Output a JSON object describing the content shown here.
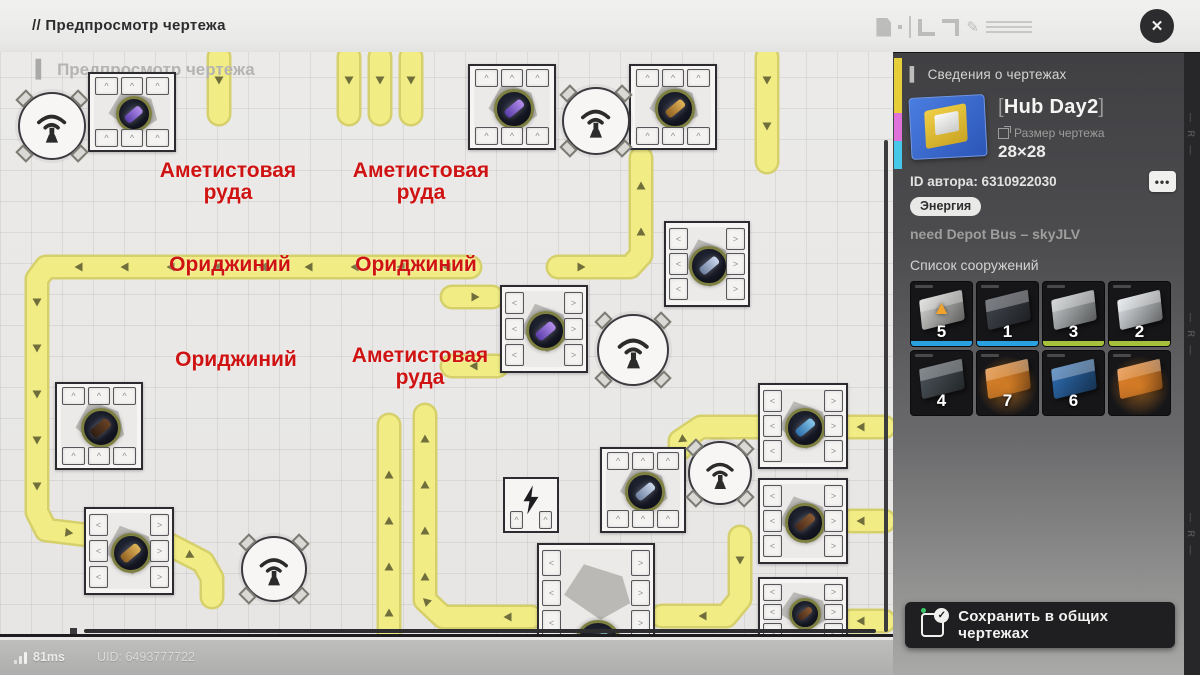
{
  "colors": {
    "belt": "#f1ec84",
    "belt_edge": "#d6d06c",
    "arrow": "#50502b",
    "label_red": "#cf1313",
    "accent_blue": "#2aa1e0",
    "accent_green": "#a6c23c",
    "save_dot_green": "#39c96a"
  },
  "top_bar": {
    "title": "// Предпросмотр чертежа",
    "close_glyph": "✕"
  },
  "map": {
    "watermark_bar": "▍",
    "watermark": "Предпросмотр чертежа",
    "labels": [
      {
        "lines": [
          "Аметистовая",
          "руда"
        ],
        "x": 228,
        "y": 160
      },
      {
        "lines": [
          "Аметистовая",
          "руда"
        ],
        "x": 421,
        "y": 160
      },
      {
        "lines": [
          "Ориджиний"
        ],
        "x": 230,
        "y": 254
      },
      {
        "lines": [
          "Ориджиний"
        ],
        "x": 416,
        "y": 254
      },
      {
        "lines": [
          "Ориджиний"
        ],
        "x": 236,
        "y": 349
      },
      {
        "lines": [
          "Аметистовая",
          "руда"
        ],
        "x": 420,
        "y": 345
      }
    ],
    "ore_colors": {
      "amethyst": [
        "#5a3daa",
        "#b48fec"
      ],
      "gold": [
        "#8f5f22",
        "#e3b559"
      ],
      "slate": [
        "#6c7f9e",
        "#cdd9ee"
      ],
      "blue": [
        "#2d6ea9",
        "#86c6ec"
      ],
      "brown": [
        "#45291a",
        "#8a5a32"
      ],
      "darkbrown": [
        "#2e1d12",
        "#6b4426"
      ],
      "teal": [
        "#2c545e",
        "#79a7b0"
      ]
    },
    "machines": [
      {
        "x": 88,
        "y": 72,
        "w": 88,
        "h": 80,
        "ore": "amethyst",
        "ports": [
          "top",
          "bottom"
        ]
      },
      {
        "x": 468,
        "y": 64,
        "w": 88,
        "h": 86,
        "ore": "amethyst",
        "ports": [
          "top",
          "bottom"
        ]
      },
      {
        "x": 629,
        "y": 64,
        "w": 88,
        "h": 86,
        "ore": "gold",
        "ports": [
          "top",
          "bottom"
        ]
      },
      {
        "x": 664,
        "y": 221,
        "w": 86,
        "h": 86,
        "ore": "slate",
        "ports": [
          "left",
          "right"
        ]
      },
      {
        "x": 500,
        "y": 285,
        "w": 88,
        "h": 88,
        "ore": "amethyst",
        "ports": [
          "left",
          "right"
        ]
      },
      {
        "x": 55,
        "y": 382,
        "w": 88,
        "h": 88,
        "ore": "darkbrown",
        "ports": [
          "top",
          "bottom"
        ]
      },
      {
        "x": 600,
        "y": 447,
        "w": 86,
        "h": 86,
        "ore": "slate",
        "ports": [
          "top",
          "bottom"
        ]
      },
      {
        "x": 758,
        "y": 383,
        "w": 90,
        "h": 86,
        "ore": "blue",
        "ports": [
          "left",
          "right"
        ]
      },
      {
        "x": 758,
        "y": 478,
        "w": 90,
        "h": 86,
        "ore": "brown",
        "ports": [
          "left",
          "right"
        ]
      },
      {
        "x": 758,
        "y": 577,
        "w": 90,
        "h": 70,
        "ore": "brown",
        "ports": [
          "left",
          "right"
        ]
      },
      {
        "x": 84,
        "y": 507,
        "w": 90,
        "h": 88,
        "ore": "gold",
        "ports": [
          "left",
          "right"
        ]
      },
      {
        "x": 537,
        "y": 543,
        "w": 118,
        "h": 100,
        "ore": "teal",
        "ports": [
          "left",
          "right"
        ],
        "ore_pos": "bottom"
      },
      {
        "x": 503,
        "y": 477,
        "w": 56,
        "h": 56,
        "type": "power"
      }
    ],
    "antennas": [
      {
        "x": 18,
        "y": 92,
        "d": 68
      },
      {
        "x": 562,
        "y": 87,
        "d": 68
      },
      {
        "x": 597,
        "y": 314,
        "d": 72
      },
      {
        "x": 688,
        "y": 441,
        "d": 64
      },
      {
        "x": 241,
        "y": 536,
        "d": 66
      }
    ],
    "belts": [
      {
        "points": [
          [
            219,
            57
          ],
          [
            219,
            114
          ]
        ]
      },
      {
        "points": [
          [
            349,
            57
          ],
          [
            349,
            114
          ]
        ]
      },
      {
        "points": [
          [
            380,
            57
          ],
          [
            380,
            114
          ]
        ]
      },
      {
        "points": [
          [
            411,
            57
          ],
          [
            411,
            114
          ]
        ]
      },
      {
        "points": [
          [
            767,
            57
          ],
          [
            767,
            162
          ]
        ]
      },
      {
        "points": [
          [
            558,
            267
          ],
          [
            630,
            267
          ],
          [
            641,
            255
          ],
          [
            641,
            158
          ]
        ]
      },
      {
        "points": [
          [
            470,
            267
          ],
          [
            46,
            267
          ],
          [
            37,
            279
          ],
          [
            37,
            512
          ],
          [
            46,
            530
          ],
          [
            170,
            545
          ],
          [
            203,
            562
          ],
          [
            212,
            578
          ],
          [
            212,
            597
          ]
        ]
      },
      {
        "points": [
          [
            531,
            617
          ],
          [
            443,
            617
          ],
          [
            425,
            600
          ],
          [
            425,
            415
          ]
        ]
      },
      {
        "points": [
          [
            389,
            636
          ],
          [
            389,
            425
          ]
        ]
      },
      {
        "points": [
          [
            884,
            427
          ],
          [
            701,
            427
          ],
          [
            680,
            441
          ],
          [
            680,
            449
          ]
        ]
      },
      {
        "points": [
          [
            884,
            521
          ],
          [
            851,
            521
          ]
        ]
      },
      {
        "points": [
          [
            884,
            621
          ],
          [
            851,
            621
          ]
        ]
      },
      {
        "points": [
          [
            740,
            537
          ],
          [
            740,
            599
          ],
          [
            726,
            616
          ],
          [
            662,
            616
          ]
        ]
      },
      {
        "points": [
          [
            497,
            366
          ],
          [
            452,
            366
          ]
        ]
      },
      {
        "points": [
          [
            452,
            297
          ],
          [
            492,
            297
          ]
        ]
      }
    ]
  },
  "sidebar": {
    "header_bar": "▍",
    "header": "Сведения о чертежах",
    "blueprint": {
      "bracket_open": "[",
      "title": "Hub Day2",
      "bracket_close": "]",
      "size_label": "Размер чертежа",
      "size_value": "28×28"
    },
    "author_id": "ID автора: 6310922030",
    "more_glyph": "•••",
    "tag": "Энергия",
    "note": "need Depot Bus – skyJLV",
    "list_header": "Список сооружений",
    "items": [
      {
        "count": "5",
        "accent": "blue",
        "tone": "#d8d8d6",
        "overlay": "triangle"
      },
      {
        "count": "1",
        "accent": "blue",
        "tone": "#42464e",
        "overlay": null
      },
      {
        "count": "3",
        "accent": "green",
        "tone": "#c6cacc",
        "overlay": null
      },
      {
        "count": "2",
        "accent": "green",
        "tone": "#e2e6ea",
        "overlay": null
      },
      {
        "count": "4",
        "accent": null,
        "tone": "#4e565c",
        "overlay": null
      },
      {
        "count": "7",
        "accent": null,
        "tone": "#e0862e",
        "overlay": "glow"
      },
      {
        "count": "6",
        "accent": null,
        "tone": "#2f6fb5",
        "overlay": null
      },
      {
        "count": "",
        "accent": null,
        "tone": "#e8852f",
        "overlay": "glow"
      }
    ],
    "save_button": {
      "label": "Сохранить в общих чертежах",
      "check_glyph": "✓"
    }
  },
  "footer": {
    "ping": "81ms",
    "uid": "UID: 6493777722"
  }
}
